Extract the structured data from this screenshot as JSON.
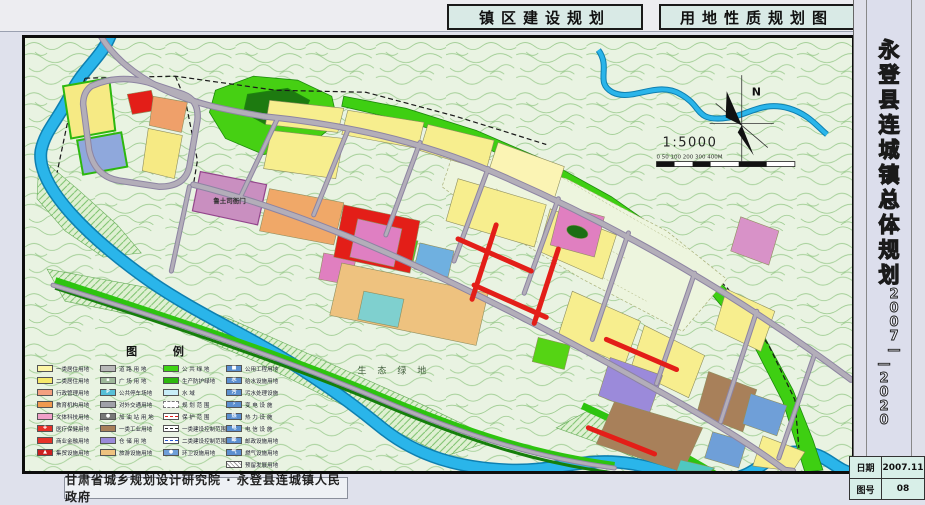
{
  "header": {
    "title_left": "镇区建设规划",
    "title_right": "用地性质规划图"
  },
  "sidebar": {
    "title": "永登县连城镇总体规划",
    "years_top": "2007—",
    "years_bottom": "—2020"
  },
  "footer": {
    "credit": "甘肃省城乡规划设计研究院 · 永登县连城镇人民政府"
  },
  "info_table": {
    "rows": [
      {
        "label": "日期",
        "value": "2007.11"
      },
      {
        "label": "图号",
        "value": "08"
      }
    ]
  },
  "map": {
    "north_label": "N",
    "scale_text": "1:5000",
    "scale_bar_labels": "0 50 100   200   300   400M",
    "labels": {
      "heritage_site": "鲁土司衙门",
      "eco_green": "生 态 绿 地"
    },
    "colors": {
      "water": "#2ab5ea",
      "public_green": "#3ecf12",
      "residential_yellow": "#f7ee8e",
      "commercial_red": "#e31e18",
      "industry_brown": "#a8805a",
      "warehouse_purple": "#9b8ada",
      "road_gray": "#b3aeb9"
    }
  },
  "legend": {
    "title": "图  例",
    "columns": [
      [
        {
          "label": "一类居住用地",
          "type": "fill",
          "color": "#fdf5a6"
        },
        {
          "label": "二类居住用地",
          "type": "fill",
          "color": "#f6e96a"
        },
        {
          "label": "行政管理用地",
          "type": "fill",
          "color": "#f4a080"
        },
        {
          "label": "教育机构用地",
          "type": "fill",
          "color": "#f09a4f"
        },
        {
          "label": "文体科技用地",
          "type": "fill",
          "color": "#f0a0c8"
        },
        {
          "label": "医疗保健用地",
          "type": "fill",
          "color": "#e63228",
          "glyph": "✚"
        },
        {
          "label": "商业金融用地",
          "type": "fill",
          "color": "#e63228"
        },
        {
          "label": "集贸设施用地",
          "type": "fill",
          "color": "#cc1f1f",
          "glyph": "▲"
        }
      ],
      [
        {
          "label": "道 路 用 地",
          "type": "fill",
          "color": "#b8b8b8"
        },
        {
          "label": "广 场 用 地",
          "type": "fill",
          "color": "#9fb89a",
          "glyph": "▪"
        },
        {
          "label": "公共停车场地",
          "type": "fill",
          "color": "#58c0d8",
          "glyph": "P"
        },
        {
          "label": "对外交通用地",
          "type": "fill",
          "color": "#a0a0a8"
        },
        {
          "label": "加 油 站 用 地",
          "type": "fill",
          "color": "#787878",
          "glyph": "●"
        },
        {
          "label": "一类工业用地",
          "type": "fill",
          "color": "#a8805a"
        },
        {
          "label": "仓 储 用 地",
          "type": "fill",
          "color": "#9b8ada"
        },
        {
          "label": "旅游设施用地",
          "type": "fill",
          "color": "#eec27f"
        }
      ],
      [
        {
          "label": "公 共 绿 地",
          "type": "fill",
          "color": "#3fd414"
        },
        {
          "label": "生产防护绿地",
          "type": "fill",
          "color": "#2db80e"
        },
        {
          "label": "水    域",
          "type": "fill",
          "color": "#c8eef8"
        },
        {
          "label": "规 划 范 围",
          "type": "outline"
        },
        {
          "label": "保 护 范 围",
          "type": "line",
          "lineStyle": "dashed",
          "lineColor": "#e31e18"
        },
        {
          "label": "一类建设控制范围",
          "type": "line",
          "lineStyle": "dashed",
          "lineColor": "#222222"
        },
        {
          "label": "二类建设控制范围",
          "type": "line",
          "lineStyle": "dashed",
          "lineColor": "#2255cc"
        },
        {
          "label": "环卫设施用地",
          "type": "fill",
          "color": "#6f9fd8",
          "glyph": "●"
        }
      ],
      [
        {
          "label": "公用工程用地",
          "type": "fill",
          "color": "#5b8fd0",
          "glyph": "■"
        },
        {
          "label": "给水设施用地",
          "type": "fill",
          "color": "#5b8fd0",
          "glyph": "水"
        },
        {
          "label": "污水处理设施",
          "type": "fill",
          "color": "#5b8fd0",
          "glyph": "污"
        },
        {
          "label": "变 电 设 施",
          "type": "fill",
          "color": "#5b8fd0",
          "glyph": "⚡"
        },
        {
          "label": "热 力 设 施",
          "type": "fill",
          "color": "#5b8fd0",
          "glyph": "热"
        },
        {
          "label": "电 信 设 施",
          "type": "fill",
          "color": "#5b8fd0",
          "glyph": "电"
        },
        {
          "label": "邮政设施用地",
          "type": "fill",
          "color": "#5b8fd0",
          "glyph": "邮"
        },
        {
          "label": "燃气设施用地",
          "type": "fill",
          "color": "#5b8fd0",
          "glyph": "气"
        },
        {
          "label": "预留发展用地",
          "type": "hatch"
        }
      ]
    ]
  }
}
